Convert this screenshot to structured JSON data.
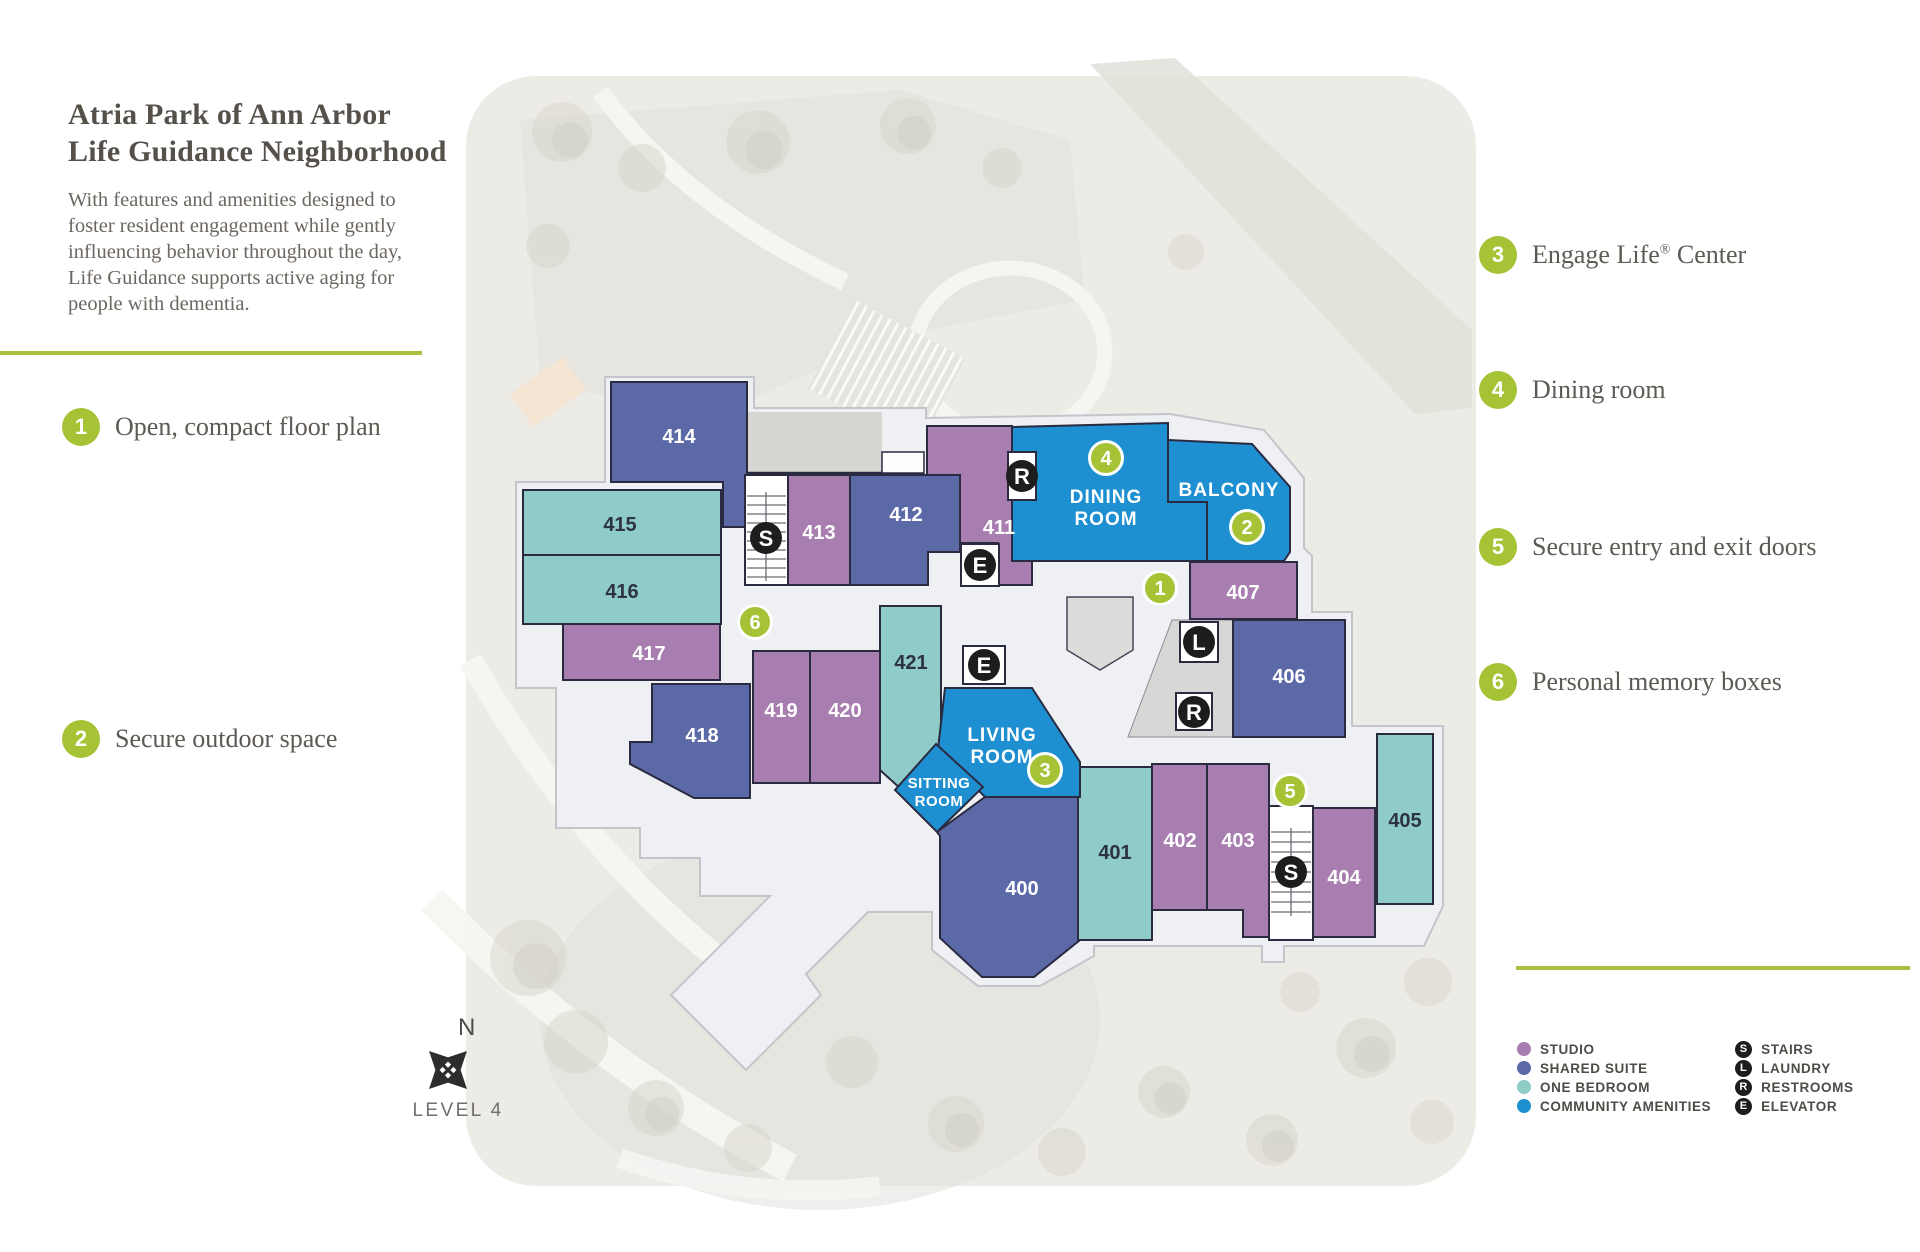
{
  "page": {
    "title_line1": "Atria Park of Ann Arbor",
    "title_line2": "Life Guidance Neighborhood",
    "description": "With features and amenities designed to foster resident engagement while gently influencing behavior throughout the day, Life Guidance supports active aging for people with dementia."
  },
  "callouts_left": [
    {
      "number": "1",
      "label": "Open, compact floor plan"
    },
    {
      "number": "2",
      "label": "Secure outdoor space"
    }
  ],
  "callouts_right": [
    {
      "number": "3",
      "label": "Engage Life",
      "sup": "®",
      "label_after": " Center"
    },
    {
      "number": "4",
      "label": "Dining room",
      "sup": "",
      "label_after": ""
    },
    {
      "number": "5",
      "label": "Secure entry and exit doors",
      "sup": "",
      "label_after": ""
    },
    {
      "number": "6",
      "label": "Personal memory boxes",
      "sup": "",
      "label_after": ""
    }
  ],
  "floorplan": {
    "level": "LEVEL 4",
    "north": "N",
    "rooms": {
      "r400": "400",
      "r401": "401",
      "r402": "402",
      "r403": "403",
      "r404": "404",
      "r405": "405",
      "r406": "406",
      "r407": "407",
      "r411": "411",
      "r412": "412",
      "r413": "413",
      "r414": "414",
      "r415": "415",
      "r416": "416",
      "r417": "417",
      "r418": "418",
      "r419": "419",
      "r420": "420",
      "r421": "421"
    },
    "spaces": {
      "dining1": "DINING",
      "dining2": "ROOM",
      "balcony": "BALCONY",
      "living1": "LIVING",
      "living2": "ROOM",
      "sitting1": "SITTING",
      "sitting2": "ROOM"
    },
    "badges": {
      "b1": "1",
      "b2": "2",
      "b3": "3",
      "b4": "4",
      "b5": "5",
      "b6": "6"
    },
    "icons": {
      "stairs": "S",
      "laundry": "L",
      "restrooms": "R",
      "elevator": "E"
    }
  },
  "legend": {
    "types": [
      {
        "label": "STUDIO",
        "color": "#a87db0"
      },
      {
        "label": "SHARED SUITE",
        "color": "#5c69a7"
      },
      {
        "label": "ONE BEDROOM",
        "color": "#8fcbc7"
      },
      {
        "label": "COMMUNITY AMENITIES",
        "color": "#1e8fd0"
      }
    ],
    "icons": [
      {
        "letter": "S",
        "label": "STAIRS"
      },
      {
        "letter": "L",
        "label": "LAUNDRY"
      },
      {
        "letter": "R",
        "label": "RESTROOMS"
      },
      {
        "letter": "E",
        "label": "ELEVATOR"
      }
    ]
  },
  "colors": {
    "accent_green": "#a6c336",
    "studio": "#a87db0",
    "shared_suite": "#5c69a7",
    "one_bedroom": "#8fcbc7",
    "community": "#1e8fd0"
  }
}
